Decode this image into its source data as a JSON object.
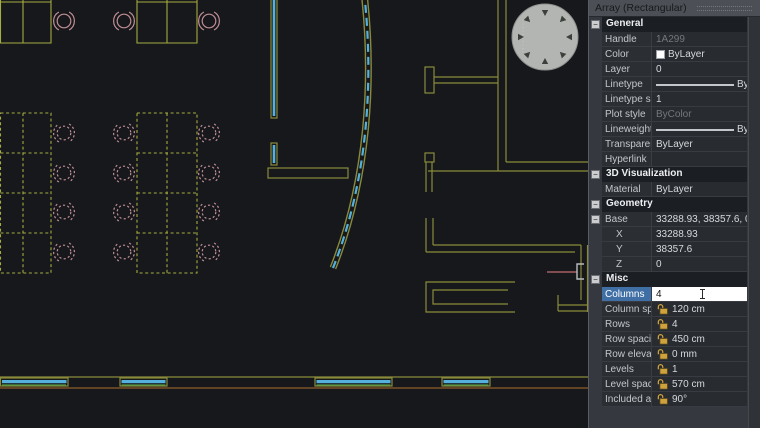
{
  "colors": {
    "background": "#16181c",
    "desk": "#a6ab3f",
    "chair": "#c08d94",
    "wall": "#8a8b3a",
    "wall_brown": "#7c5227",
    "glass_cyan": "#55b0dc",
    "glass_green": "#4f9a48",
    "column_gray": "#b3b5b2",
    "column_tri": "#3c403c",
    "fixture_pink": "#a65f63",
    "bracket_gray": "#b9bcbe",
    "selection_blue": "#3f6fa5",
    "lock_gold": "#cfa23d",
    "panel_bg": "#35393f",
    "panel_row": "#2b2e33",
    "panel_value": "#282b30",
    "panel_header": "#1b1e23",
    "panel_title_bg": "#4c5056"
  },
  "panel": {
    "title": "Array (Rectangular)",
    "sections": [
      {
        "name": "General",
        "rows": [
          {
            "label": "Handle",
            "value": "1A299",
            "muted": true
          },
          {
            "label": "Color",
            "value": "ByLayer",
            "swatch": "#ffffff"
          },
          {
            "label": "Layer",
            "value": "0"
          },
          {
            "label": "Linetype",
            "value": "ByLayer",
            "line_sample": true
          },
          {
            "label": "Linetype scale",
            "value": "1"
          },
          {
            "label": "Plot style",
            "value": "ByColor",
            "muted": true
          },
          {
            "label": "Lineweight",
            "value": "ByLayer",
            "line_sample": true
          },
          {
            "label": "Transparency",
            "value": "ByLayer"
          },
          {
            "label": "Hyperlink",
            "value": ""
          }
        ]
      },
      {
        "name": "3D Visualization",
        "rows": [
          {
            "label": "Material",
            "value": "ByLayer"
          }
        ]
      },
      {
        "name": "Geometry",
        "rows": [
          {
            "label": "Base",
            "value": "33288.93, 38357.6, 0",
            "expand": true
          },
          {
            "label": "X",
            "value": "33288.93",
            "indent": true
          },
          {
            "label": "Y",
            "value": "38357.6",
            "indent": true
          },
          {
            "label": "Z",
            "value": "0",
            "indent": true
          }
        ]
      },
      {
        "name": "Misc",
        "rows": [
          {
            "label": "Columns",
            "value": "4",
            "editing": true
          },
          {
            "label": "Column spacing",
            "value": "120 cm",
            "lock": true
          },
          {
            "label": "Rows",
            "value": "4",
            "lock": true
          },
          {
            "label": "Row spacing",
            "value": "450 cm",
            "lock": true
          },
          {
            "label": "Row elevation in",
            "value": "0 mm",
            "lock": true
          },
          {
            "label": "Levels",
            "value": "1",
            "lock": true
          },
          {
            "label": "Level spacing",
            "value": "570 cm",
            "lock": true
          },
          {
            "label": "Included axis ang",
            "value": "90°",
            "lock": true
          }
        ]
      }
    ]
  }
}
